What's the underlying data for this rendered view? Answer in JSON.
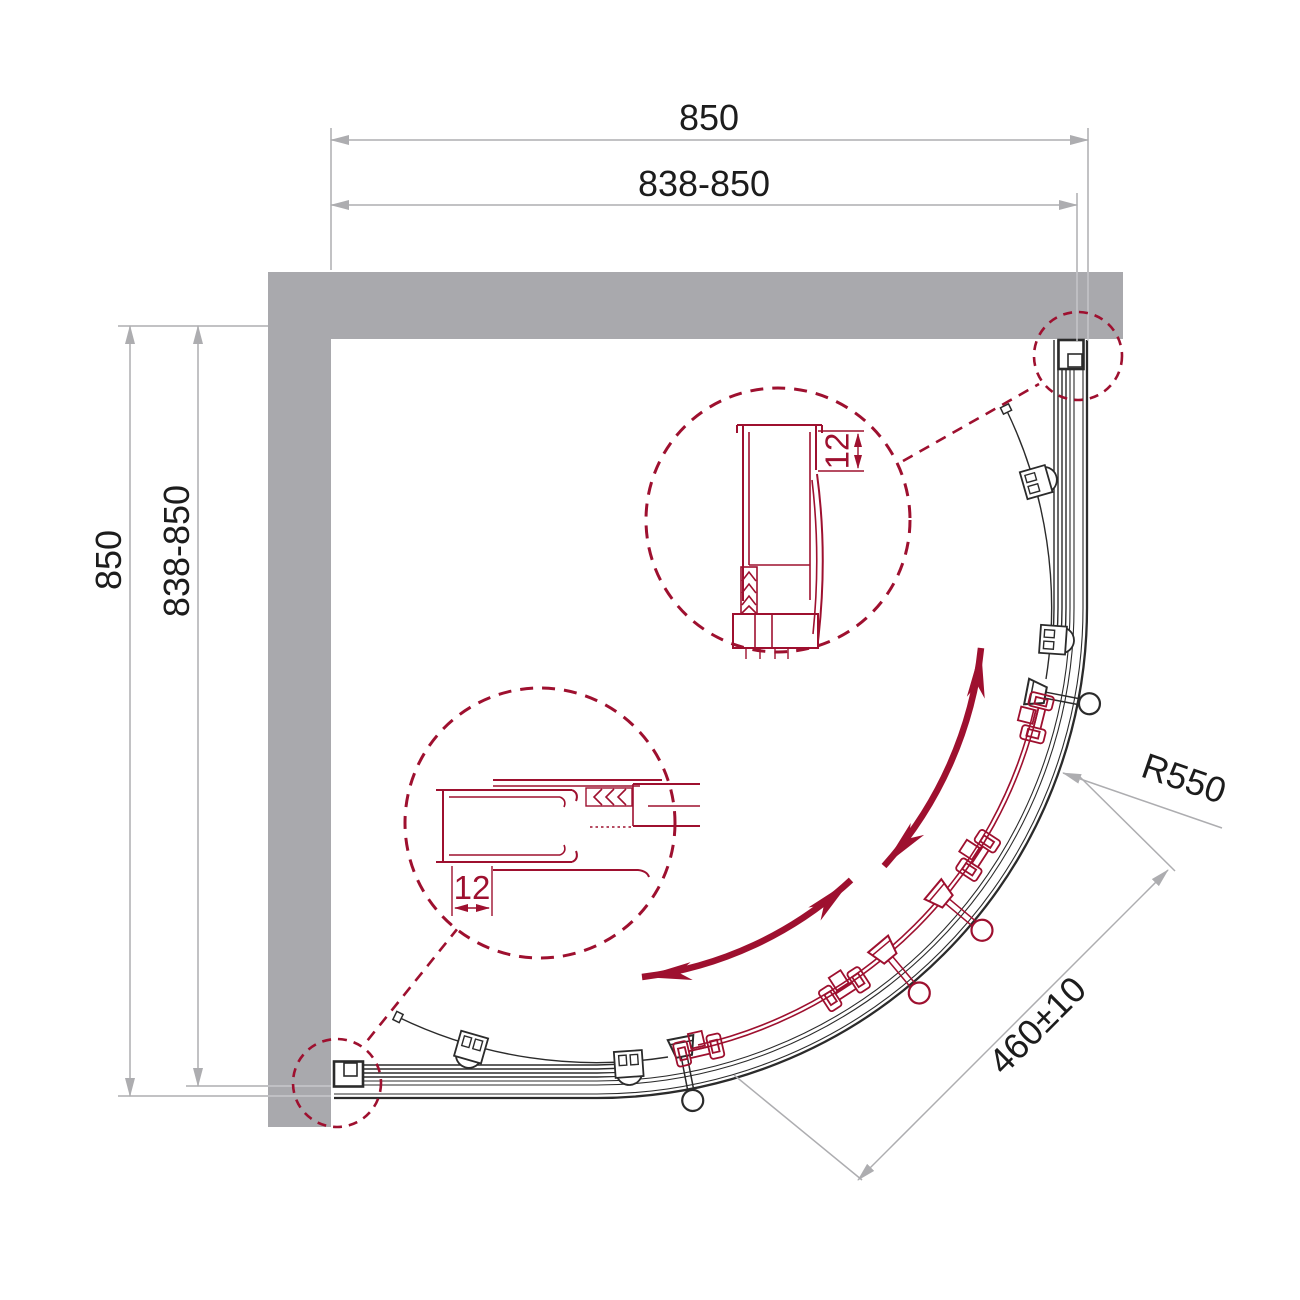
{
  "dims": {
    "top_total": "850",
    "top_range": "838-850",
    "left_total": "850",
    "left_range": "838-850",
    "radius": "R550",
    "entry": "460±10",
    "profile_top": "12",
    "profile_bottom": "12"
  },
  "colors": {
    "accent": "#9E102F",
    "wall": "#A9A9AD",
    "dim_line": "#ADADB0",
    "drawing_line": "#2B2B2B"
  }
}
